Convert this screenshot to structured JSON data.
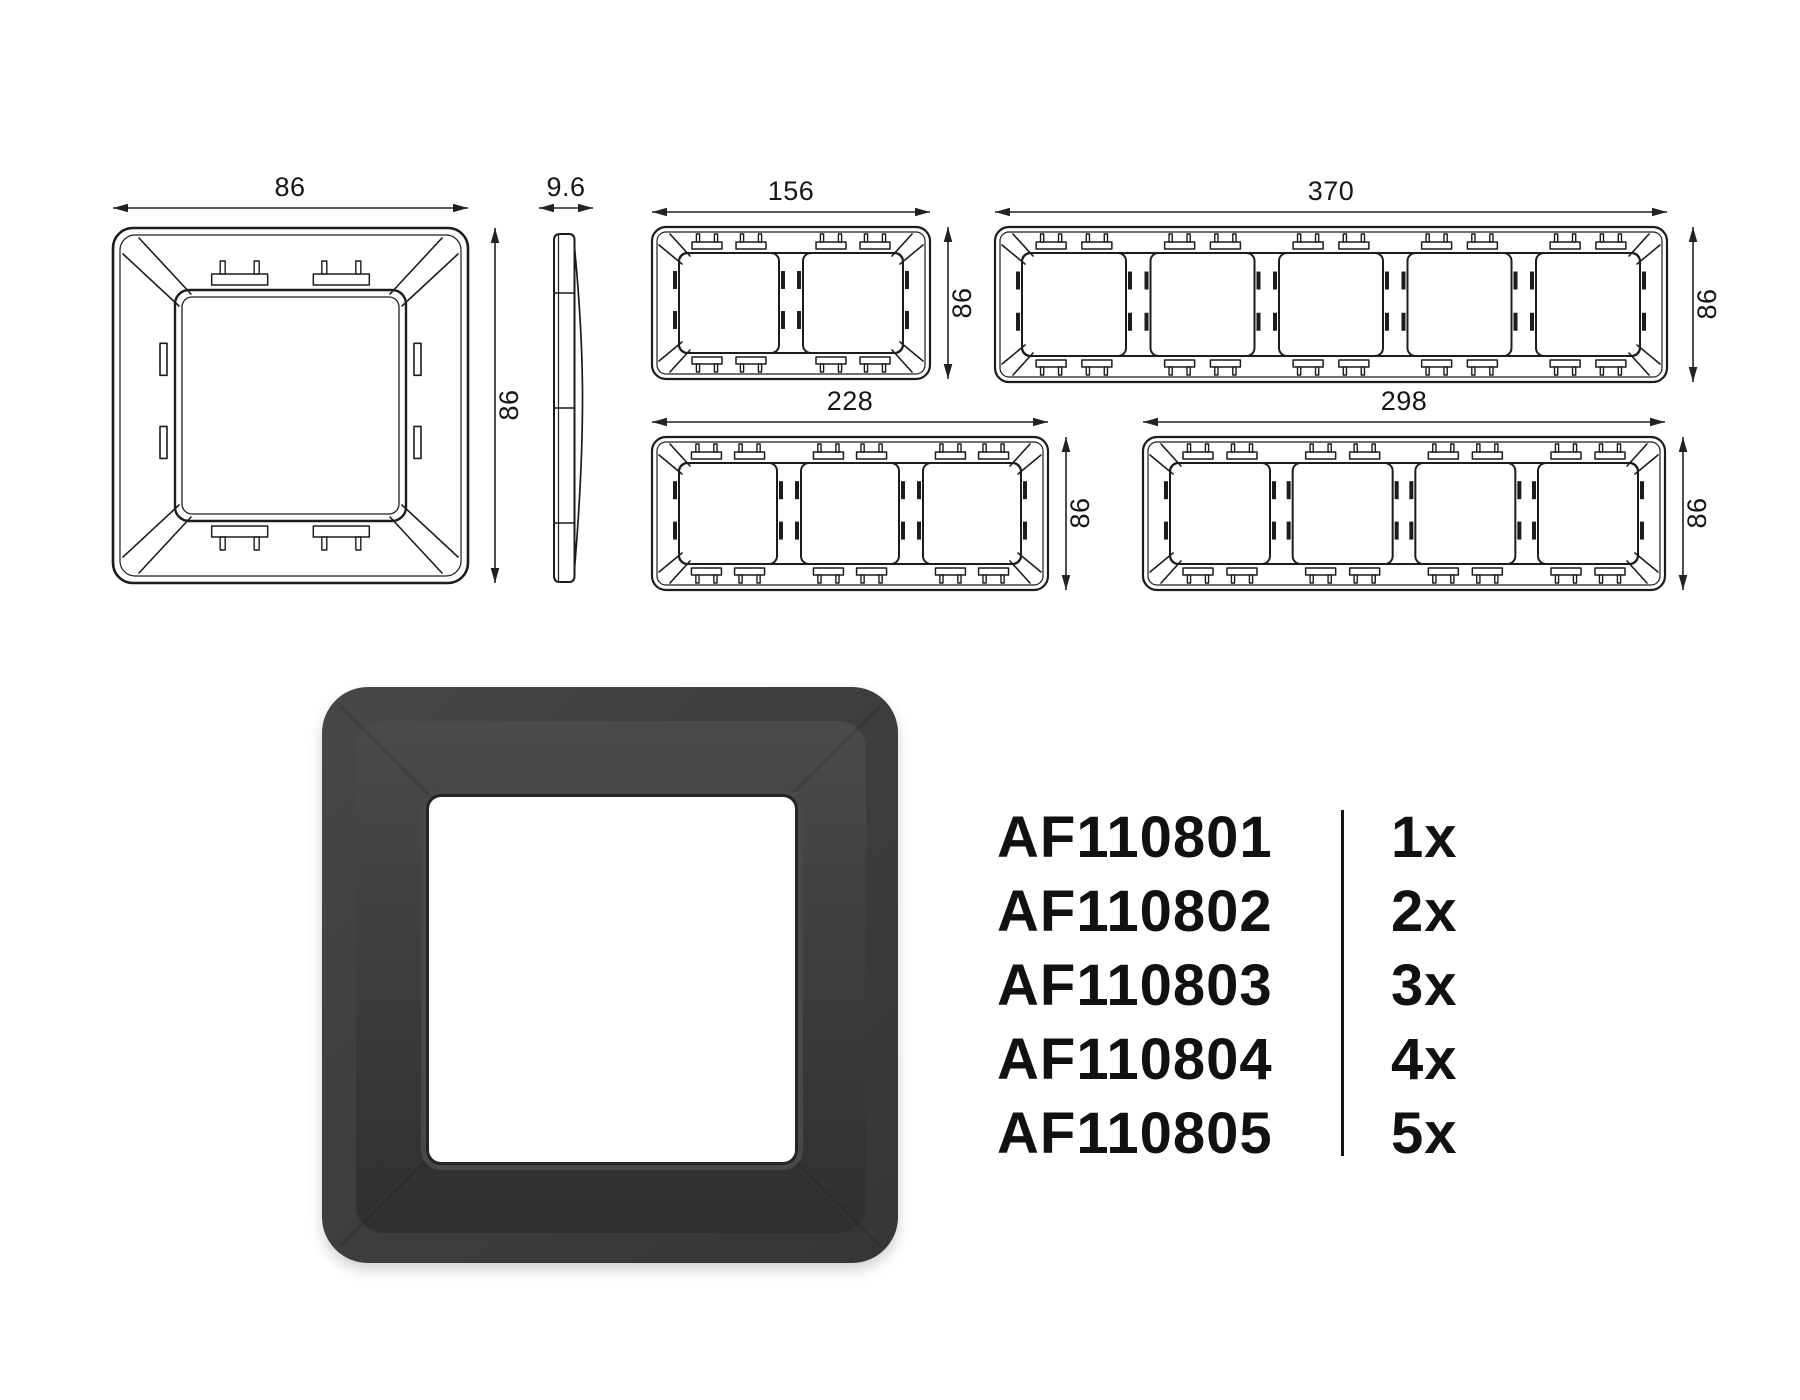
{
  "dimensions": {
    "single": {
      "width": "86",
      "height": "86"
    },
    "profile": {
      "thickness": "9.6"
    },
    "two_gang": {
      "width": "156",
      "height": "86"
    },
    "three_gang": {
      "width": "228",
      "height": "86"
    },
    "four_gang": {
      "width": "298",
      "height": "86"
    },
    "five_gang": {
      "width": "370",
      "height": "86"
    }
  },
  "render": {
    "plate_color": "#3e3e3e"
  },
  "product_table": {
    "rows": [
      {
        "code": "AF110801",
        "qty": "1x"
      },
      {
        "code": "AF110802",
        "qty": "2x"
      },
      {
        "code": "AF110803",
        "qty": "3x"
      },
      {
        "code": "AF110804",
        "qty": "4x"
      },
      {
        "code": "AF110805",
        "qty": "5x"
      }
    ]
  }
}
